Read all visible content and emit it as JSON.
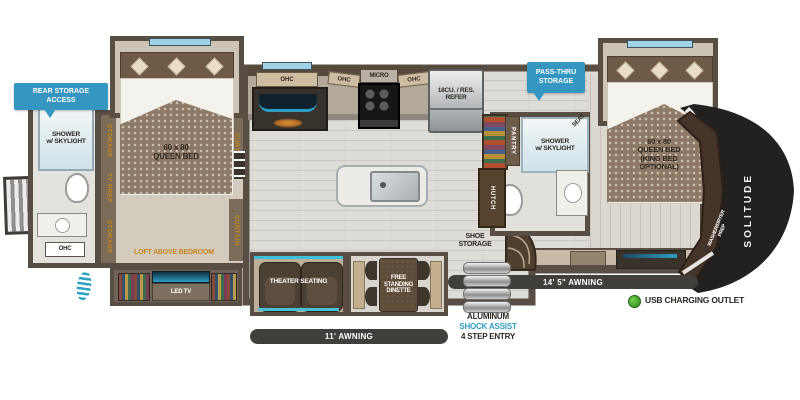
{
  "banners": {
    "rear_storage_access": "REAR STORAGE\nACCESS",
    "pass_thru_storage": "PASS-THRU\nSTORAGE"
  },
  "rear_bath": {
    "shower": "SHOWER\nw/ SKYLIGHT",
    "ohc": "OHC"
  },
  "bedroom": {
    "storage_top": "STORAGE",
    "tv_prep": "TV PREP",
    "storage_bottom": "STORAGE",
    "curtain_top": "CURTAIN",
    "curtain_bottom": "CURTAIN",
    "queen_bed": "60 x 80\nQUEEN BED",
    "loft": "LOFT ABOVE BEDROOM",
    "led_tv": "LED TV"
  },
  "kitchen": {
    "ohc_left": "OHC",
    "ohc_mid": "OHC",
    "micro": "MICRO",
    "ohc_right": "OHC",
    "refer": "18CU. / RES.\nREFER",
    "ent_center": "ENT. CENTER\nLED TV w/ FIREPLACE",
    "oven": "24\" RESIDENTIAL\nOVEN",
    "dishwasher_prep": "DISHWASHER PREP"
  },
  "mid_bath": {
    "pantry": "PANTRY",
    "hutch": "HUTCH",
    "shower": "SHOWER\nw/ SKYLIGHT",
    "seat": "SEAT"
  },
  "front_bedroom": {
    "queen_bed": "60 x 80\nQUEEN BED\n(KING BED\nOPTIONAL)",
    "washer_dryer_prep": "WASHER/DRYER\nPREP",
    "brand": "SOLITUDE"
  },
  "living": {
    "theater_seating": "THEATER SEATING",
    "dinette": "FREE\nSTANDING\nDINETTE",
    "shoe_storage": "SHOE\nSTORAGE"
  },
  "exterior": {
    "awning_rear": "11'  AWNING",
    "awning_main": "14' 5\" AWNING",
    "usb": "USB CHARGING OUTLET",
    "entry_material": "ALUMINUM",
    "entry_shock": "SHOCK ASSIST",
    "entry_steps": "4 STEP ENTRY"
  },
  "colors": {
    "banner_blue": "#3596c1",
    "accent_gold": "#c8871e",
    "usb_green": "#41a32d",
    "shock_blue": "#2f9dc4",
    "awning_dark": "#413f3c"
  }
}
